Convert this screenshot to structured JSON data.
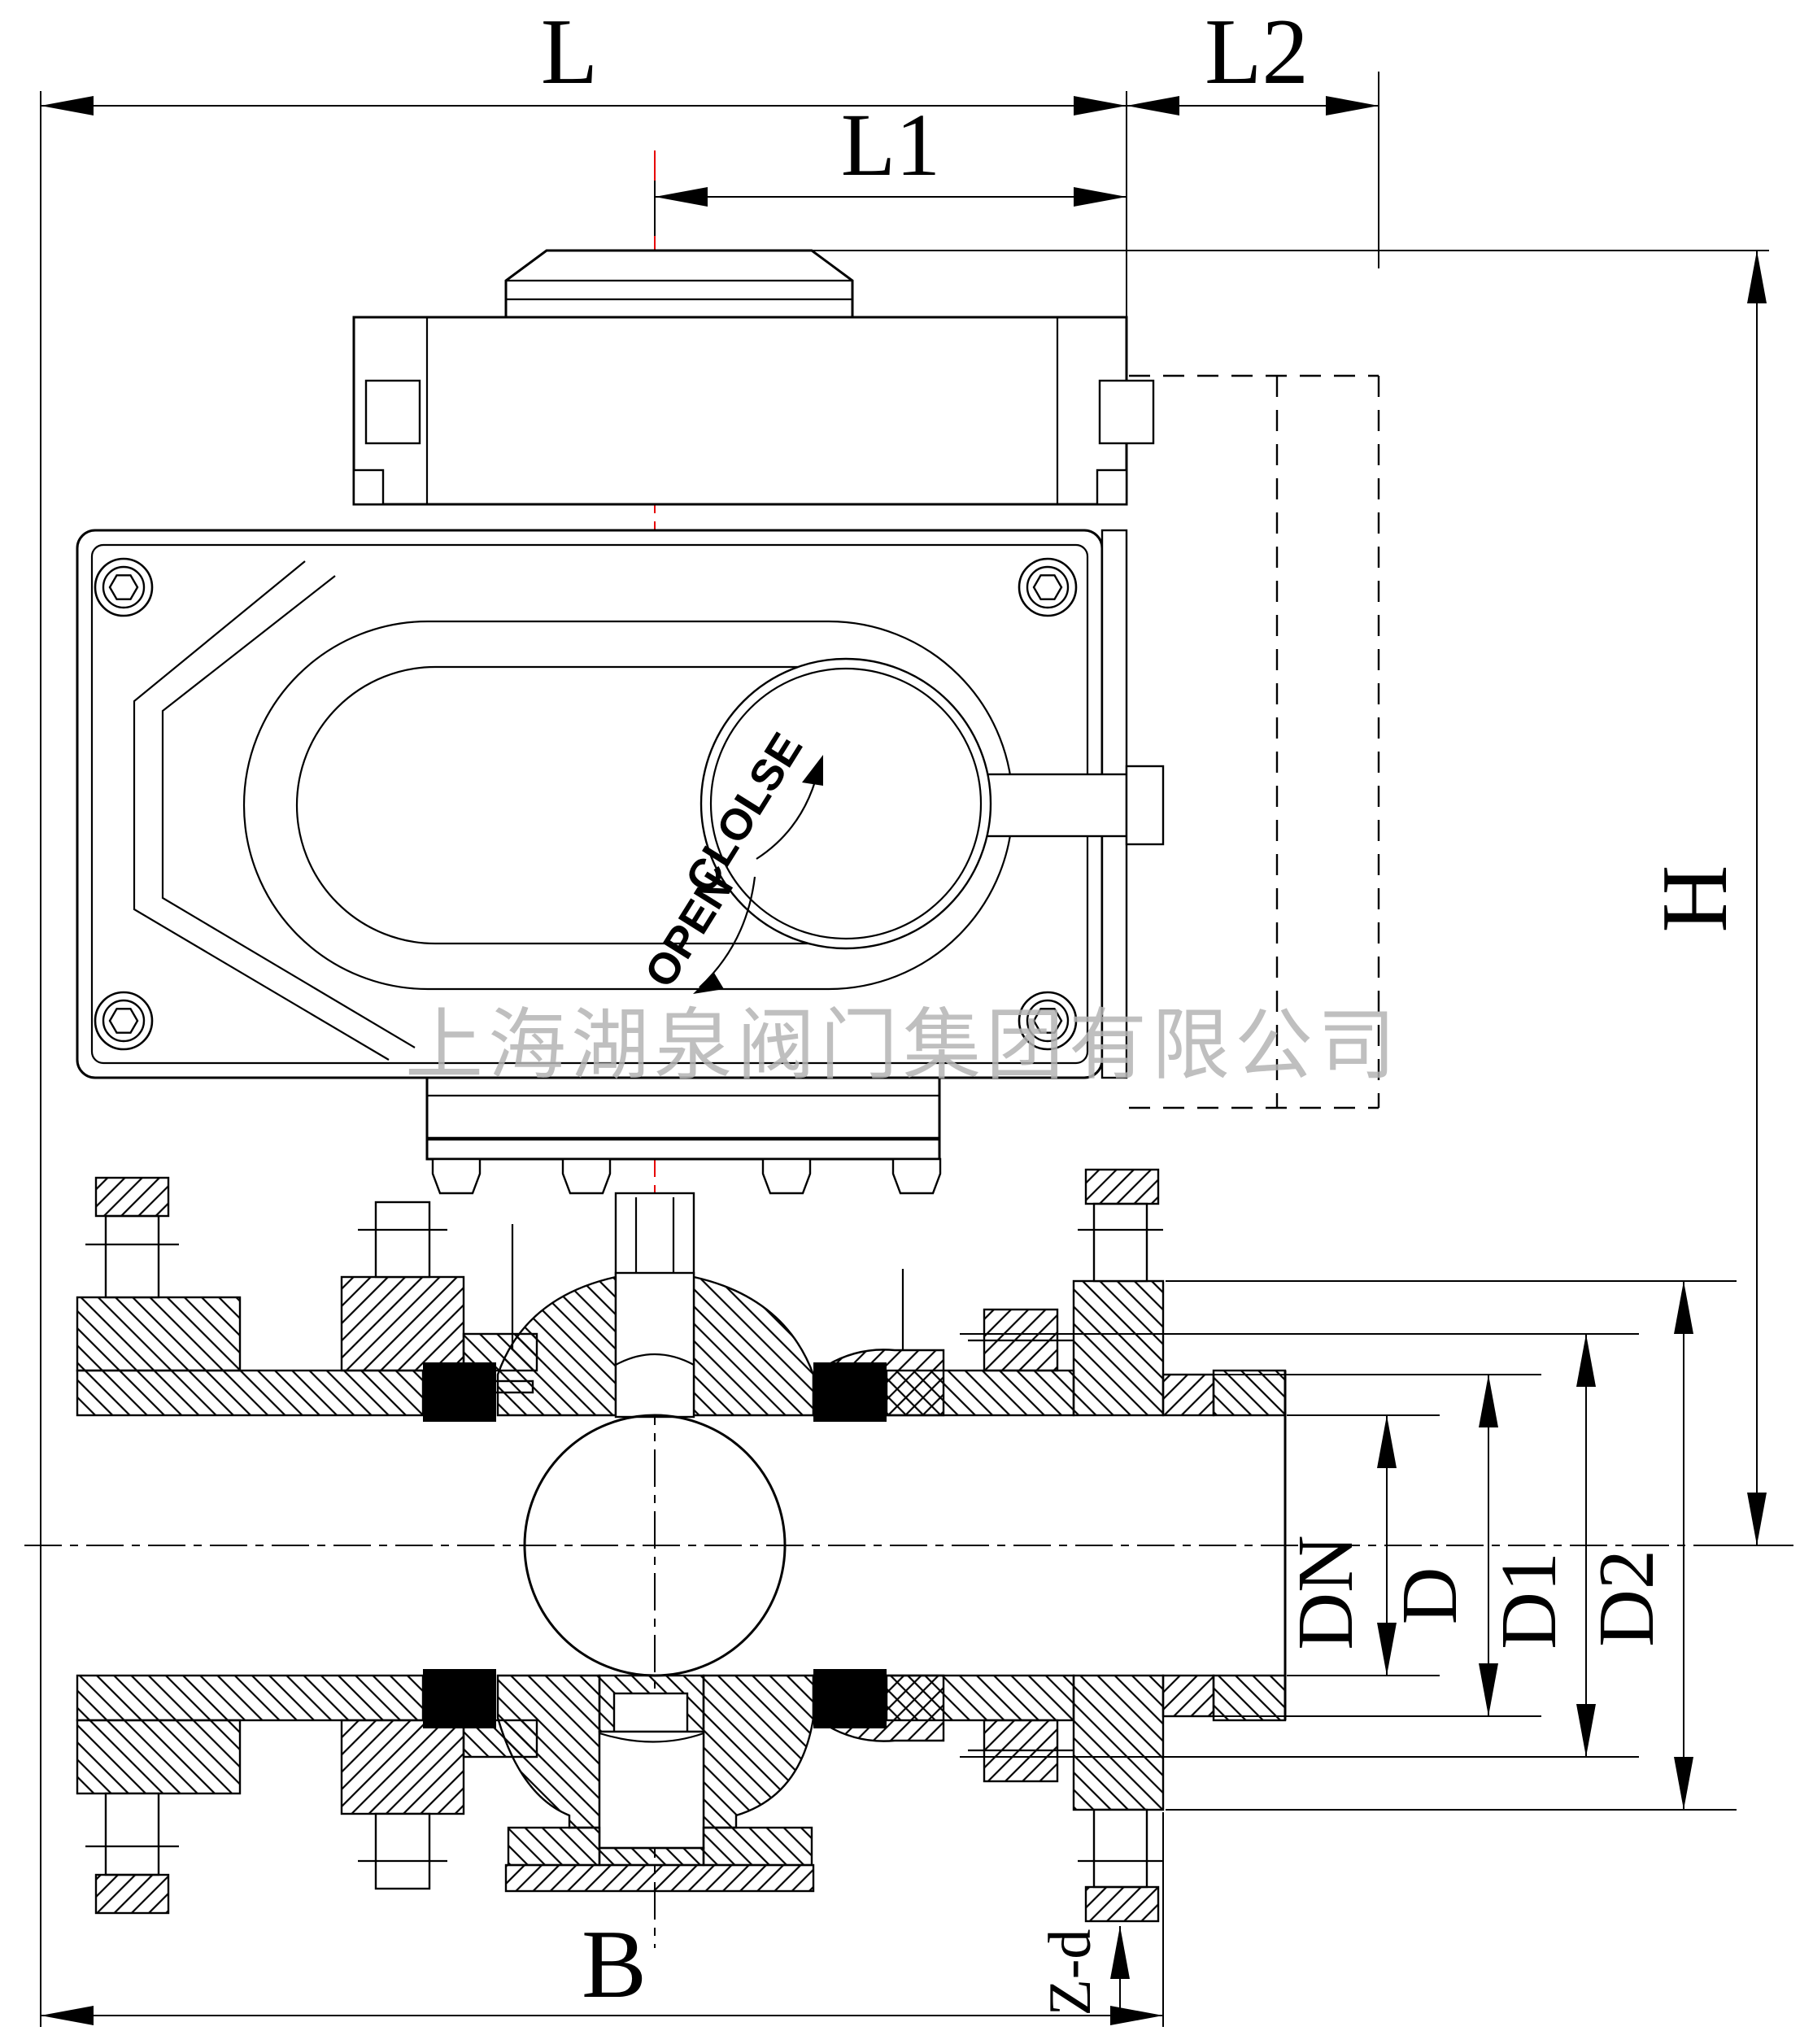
{
  "watermark": {
    "text": "上海湖泉阀门集团有限公司"
  },
  "actuator": {
    "close_label": "CLOLSE",
    "open_label": "OPEN"
  },
  "dimensions": {
    "L": "L",
    "L1": "L1",
    "L2": "L2",
    "H": "H",
    "B": "B",
    "DN": "DN",
    "D": "D",
    "D1": "D1",
    "D2": "D2",
    "Z_d": "Z-d"
  },
  "colors": {
    "line": "#000000",
    "centerline_red": "#e60000",
    "watermark_gray": "#b4b4b4",
    "background": "#ffffff"
  }
}
